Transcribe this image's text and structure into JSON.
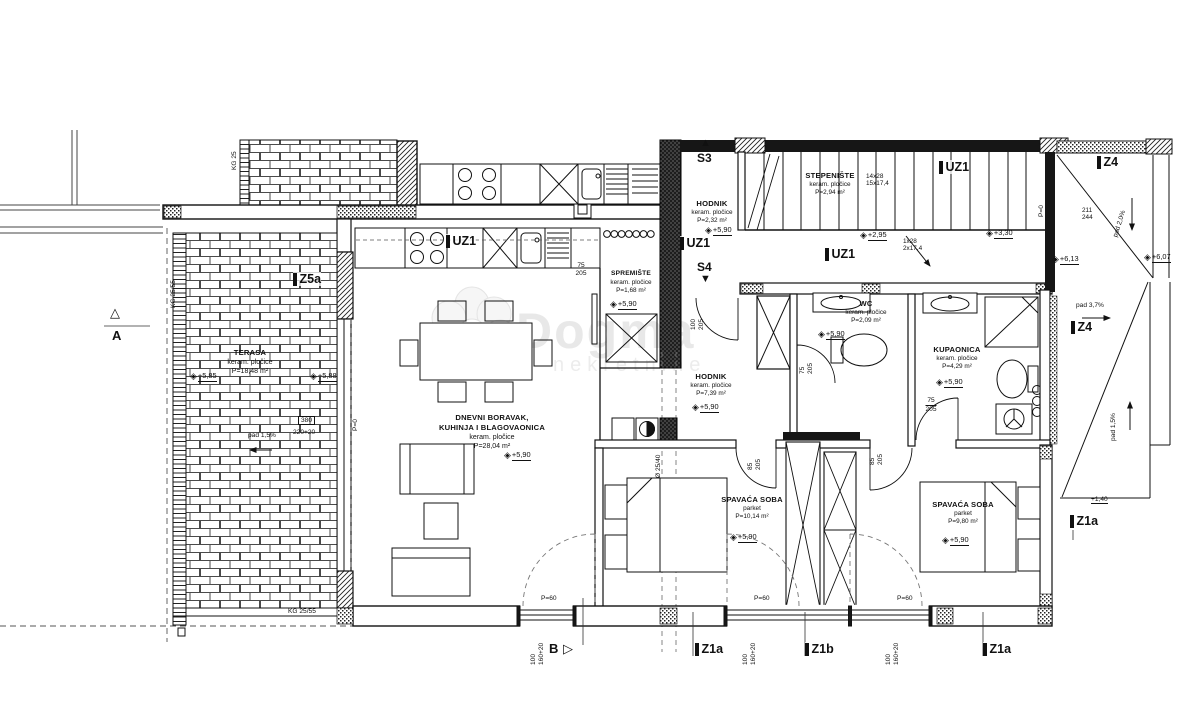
{
  "watermark": {
    "brand": "Dogma",
    "sub": "nekretnine"
  },
  "icons": {
    "level_diamond": "◈",
    "triangle_up": "▲",
    "triangle_down": "▼",
    "triangle_right": "▷",
    "triangle_up_outline": "△"
  },
  "sections": {
    "a": "A",
    "b": "B",
    "s3": "S3",
    "s4": "S4"
  },
  "tags": {
    "uz1": "UZ1",
    "z5a": "Z5a",
    "z4": "Z4",
    "z1a": "Z1a",
    "z1b": "Z1b"
  },
  "rooms": {
    "terasa": {
      "name": "TERASA",
      "finish": "keram. pločice",
      "area": "P=18,48 m²",
      "level_left": "+5,85",
      "level_right": "+5,88",
      "slope": "pad 1,5%",
      "dim_w": "380",
      "dim_h": "220+20"
    },
    "dnevni": {
      "name": "DNEVNI BORAVAK,",
      "name2": "KUHINJA I BLAGOVAONICA",
      "finish": "keram. pločice",
      "area": "P=28,04 m²",
      "level": "+5,90"
    },
    "spremiste": {
      "name": "SPREMIŠTE",
      "finish": "keram. pločice",
      "area": "P=1,68 m²",
      "level": "+5,90"
    },
    "hodnik_gornji": {
      "name": "HODNIK",
      "finish": "keram. pločice",
      "area": "P=2,32 m²",
      "level": "+5,90"
    },
    "stepeniste": {
      "name": "STEPENIŠTE",
      "finish": "keram. pločice",
      "area": "P=2,94 m²",
      "risers_a": "14x28",
      "risers_b": "15x17,4",
      "risers_c": "1x28",
      "risers_d": "2x17,4",
      "level_mid": "+2,95",
      "level_side": "+3,30"
    },
    "wc": {
      "name": "WC",
      "finish": "keram. pločice",
      "area": "P=2,09 m²",
      "level": "+5,90"
    },
    "kupaonica": {
      "name": "KUPAONICA",
      "finish": "keram. pločice",
      "area": "P=4,29 m²",
      "level": "+5,90"
    },
    "hodnik": {
      "name": "HODNIK",
      "finish": "keram. pločice",
      "area": "P=7,39 m²",
      "level": "+5,90"
    },
    "spavaca_1": {
      "name": "SPAVAĆA SOBA",
      "finish": "parket",
      "area": "P=10,14 m²",
      "level": "+5,90"
    },
    "spavaca_2": {
      "name": "SPAVAĆA SOBA",
      "finish": "parket",
      "area": "P=9,80 m²",
      "level": "+5,90"
    }
  },
  "outdoor": {
    "level_a": "+6,13",
    "level_b": "+6,07",
    "level_c": "+1,40",
    "slope_top": "pad 2,0%",
    "slope_right_a": "pad 3,7%",
    "slope_right_b": "pad 1,5%",
    "dim_w": "211",
    "dim_h": "244"
  },
  "dims": {
    "d75": "75",
    "d85": "85",
    "d100": "100",
    "h205": "205",
    "p60": "P=60",
    "p0": "P=0",
    "w100": "100",
    "h160": "160+20",
    "kg2555": "KG 25/55",
    "kg25": "KG 25",
    "column": "Ø 25/40"
  }
}
